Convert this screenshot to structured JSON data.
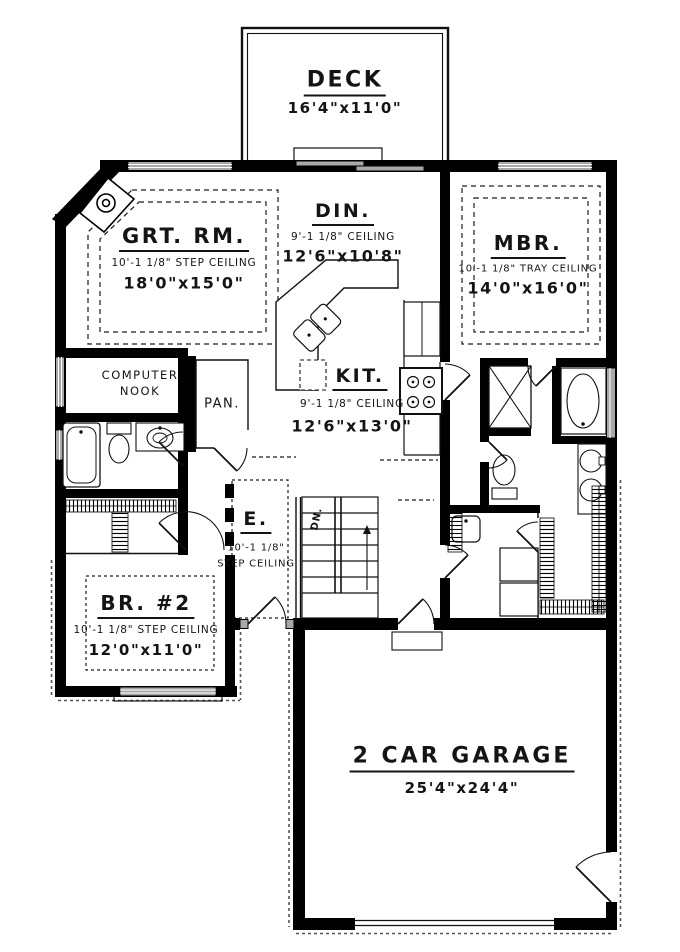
{
  "colors": {
    "ink": "#000000",
    "paper": "#ffffff",
    "window_fill": "#a8a8a8"
  },
  "rooms": {
    "deck": {
      "name": "DECK",
      "dims": "16'4\"x11'0\""
    },
    "great_room": {
      "name": "GRT. RM.",
      "ceiling": "10'-1 1/8\" STEP CEILING",
      "dims": "18'0\"x15'0\""
    },
    "dining": {
      "name": "DIN.",
      "ceiling": "9'-1 1/8\" CEILING",
      "dims": "12'6\"x10'8\""
    },
    "master_bedroom": {
      "name": "MBR.",
      "ceiling": "10'-1 1/8\" TRAY CEILING",
      "dims": "14'0\"x16'0\""
    },
    "computer_nook": {
      "line1": "COMPUTER",
      "line2": "NOOK"
    },
    "pantry": {
      "name": "PAN."
    },
    "kitchen": {
      "name": "KIT.",
      "ceiling": "9'-1 1/8\" CEILING",
      "dims": "12'6\"x13'0\""
    },
    "entry": {
      "name": "E.",
      "ceiling1": "10'-1 1/8\"",
      "ceiling2": "STEP CEILING"
    },
    "bedroom2": {
      "name": "BR. #2",
      "ceiling": "10'-1 1/8\" STEP CEILING",
      "dims": "12'0\"x11'0\""
    },
    "garage": {
      "name": "2 CAR GARAGE",
      "dims": "25'4\"x24'4\""
    },
    "stairs": {
      "label": "DN."
    }
  }
}
